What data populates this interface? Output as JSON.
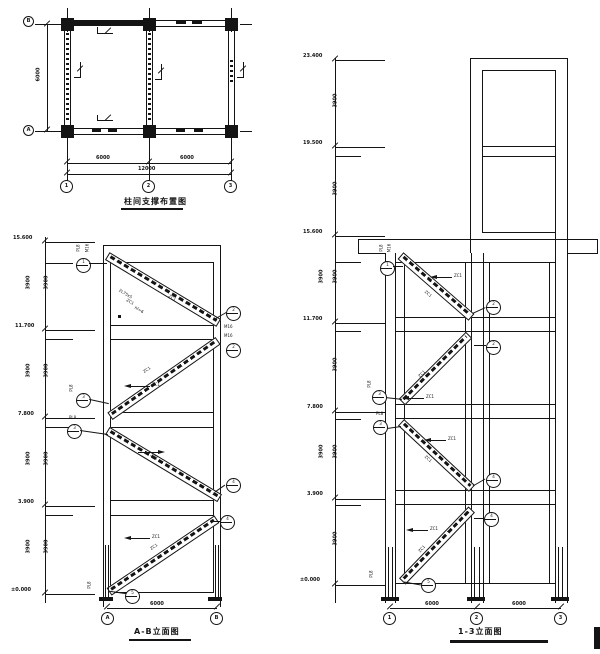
{
  "plan": {
    "title": "柱间支撑布置图",
    "axes_num": [
      "1",
      "2",
      "3"
    ],
    "axes_let": [
      "B",
      "A"
    ],
    "dims": {
      "left": "6000",
      "s1": "6000",
      "s2": "6000",
      "total": "12000"
    }
  },
  "left_elev": {
    "title": "A-B立面图",
    "levels": [
      "15.600",
      "11.700",
      "7.800",
      "3.900",
      "±0.000"
    ],
    "dims": [
      "3900",
      "3900",
      "3900",
      "3900"
    ],
    "dim_bottom": "6000",
    "axes": [
      "A",
      "B"
    ],
    "braces": [
      "ZC1",
      "ZC1",
      "ZC1",
      "ZC1"
    ],
    "leader": "ZC1",
    "callouts": [
      "1",
      "2",
      "2",
      "3",
      "3",
      "4",
      "4",
      "5"
    ],
    "tags": [
      "PL8",
      "M16"
    ],
    "node_note": [
      "2L75x5",
      "ZC1",
      "hf=6"
    ]
  },
  "right_elev": {
    "title": "1-3立面图",
    "levels": [
      "23.400",
      "19.500",
      "15.600",
      "11.700",
      "7.800",
      "3.900",
      "±0.000"
    ],
    "dims": [
      "3900",
      "3900",
      "3900",
      "3900",
      "3900",
      "3900"
    ],
    "dim_bottom": [
      "6000",
      "6000"
    ],
    "axes": [
      "1",
      "2",
      "3"
    ],
    "braces": [
      "ZC1",
      "ZC1",
      "ZC1",
      "ZC1"
    ],
    "leader": "ZC1",
    "callouts": [
      "1",
      "2",
      "2",
      "3",
      "3",
      "4",
      "4",
      "5"
    ],
    "tags": [
      "PL8",
      "M16"
    ]
  }
}
